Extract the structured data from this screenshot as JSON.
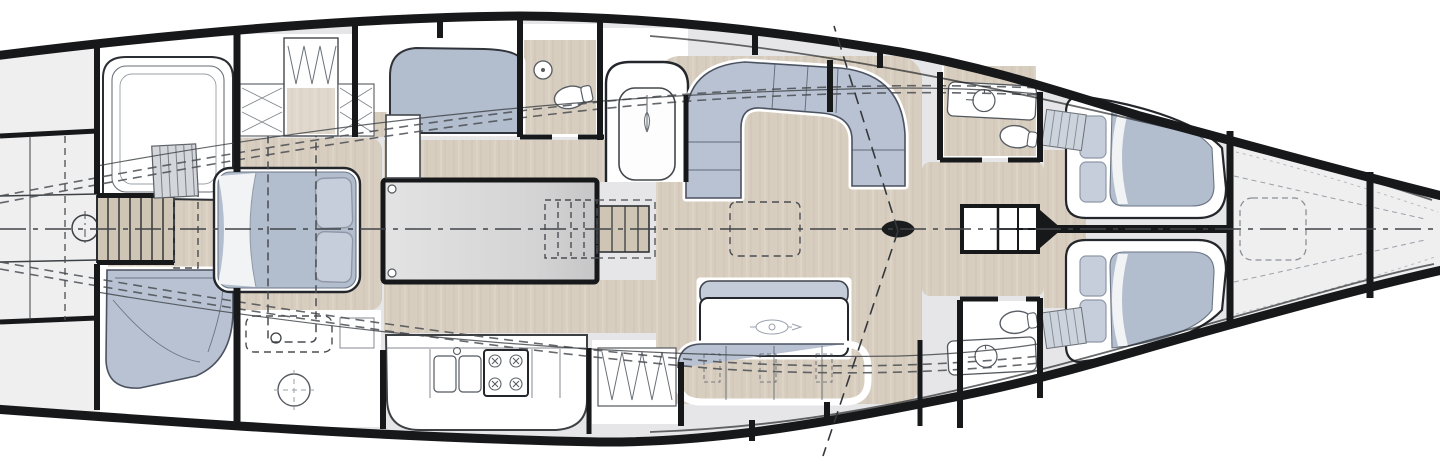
{
  "title": "sailing-yacht-interior-arrangement-plan",
  "view": "top-view-deck-plan",
  "colors": {
    "wall": "#17181a",
    "deck": "#e6e6e8",
    "deck_light": "#efeff0",
    "room": "#ffffff",
    "wood": "#d8cec0",
    "wood_line": "#c2b6a4",
    "upholstery": "#b8c2d2",
    "upholstery_edge": "#4b5260",
    "mattress": "#b2bdce",
    "pillow": "#c6cedb",
    "pillow_edge": "#8f98a6",
    "duvet": "#f2f3f5",
    "engine_hi": "#e3e3e3",
    "engine_lo": "#c6c6c7",
    "stair_wood": "#cfc5b5",
    "thin": "#3c4043",
    "dash": "#4a4d52",
    "light_dash": "#9aa0a6",
    "table_top": "#c4ccd9",
    "logo": "#98a1ad",
    "centerline": "#404449",
    "fixture": "#555a60"
  },
  "vessel": {
    "areas": [
      "cockpit",
      "companionway",
      "owners-cabin-aft",
      "dressing-area",
      "engine-room",
      "galley",
      "single-berth-cabin",
      "aft-head",
      "nav-seat",
      "saloon",
      "fwd-head-port",
      "fwd-head-starboard",
      "corridor",
      "guest-cabin-port",
      "guest-cabin-starboard",
      "forepeak",
      "bow-compartment"
    ],
    "furniture": [
      "companionway-stairs",
      "double-berth",
      "pillows",
      "settee",
      "curved-sofa",
      "hanging-locker",
      "shelf-lockers",
      "engine-box",
      "saloon-steps",
      "galley-counter",
      "double-sink",
      "stove-4-burner",
      "u-shaped-sofa",
      "dining-table",
      "bench-sofa",
      "mast",
      "locker-cabinet",
      "vanity-sink",
      "toilet",
      "v-berth",
      "deck-hatch",
      "wheel-pedestal"
    ]
  }
}
